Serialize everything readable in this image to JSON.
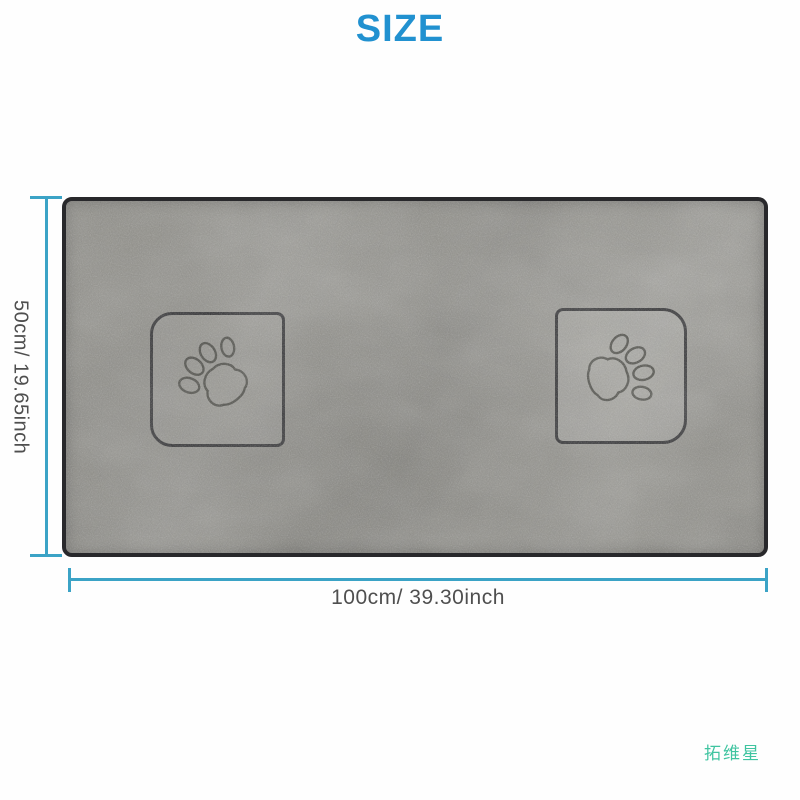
{
  "title": "SIZE",
  "diagram": {
    "height_label": "50cm/ 19.65inch",
    "width_label": "100cm/ 39.30inch"
  },
  "watermark": "拓维星",
  "towel": {
    "pockets": [
      {
        "position": "left",
        "icon": "paw-print-icon"
      },
      {
        "position": "right",
        "icon": "paw-print-icon"
      }
    ]
  },
  "colors": {
    "title": "#2191d0",
    "dimension_line": "#3ba3c6",
    "dimension_text": "#4f4f4f",
    "watermark": "#3fc4a0",
    "towel_base": "#908f89",
    "stitch_border": "#28282b",
    "background": "#fefefe"
  }
}
